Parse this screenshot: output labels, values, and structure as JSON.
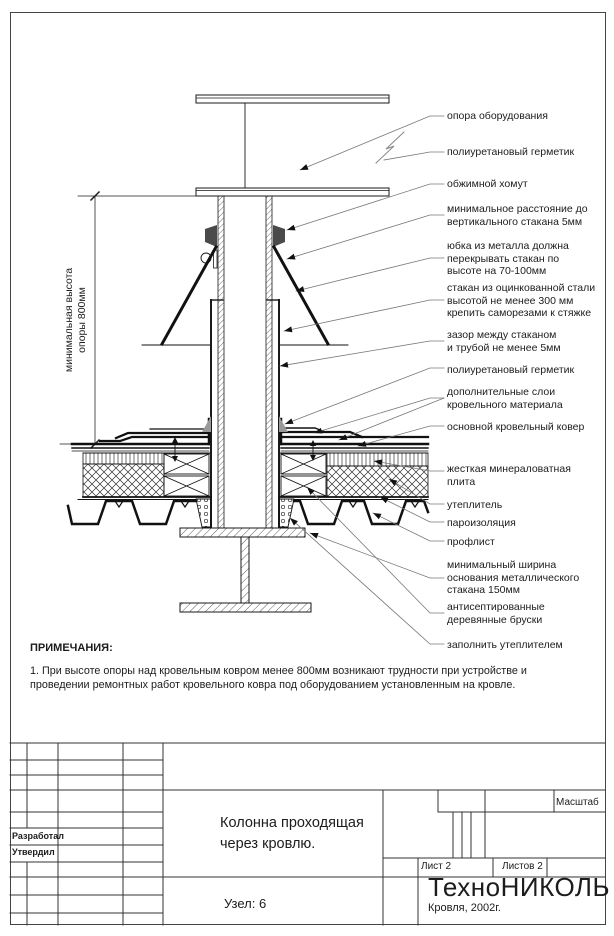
{
  "palette": {
    "line": "#1a1a1a",
    "leader": "#777777",
    "sealant_fill": "#999999",
    "clamp_fill": "#4a4a4a"
  },
  "drawing_labels": {
    "equipment_support": "опора оборудования",
    "sealant_top": "полиуретановый герметик",
    "clamp": "обжимной хомут",
    "min_distance": "минимальное расстояние до\nвертикального стакана 5мм",
    "skirt": "юбка из металла должна\nперекрывать стакан по\nвысоте на 70-100мм",
    "sleeve": "стакан из оцинкованной стали\nвысотой не менее 300 мм\nкрепить саморезами к стяжке",
    "gap": "зазор между стаканом\nи трубой не менее 5мм",
    "sealant_bottom": "полиуретановый герметик",
    "extra_layers": "дополнительные слои\nкровельного материала",
    "main_carpet": "основной кровельный ковер",
    "mineral_plate": "жесткая минераловатная\nплита",
    "insulation": "утеплитель",
    "vapor_barrier": "пароизоляция",
    "profiled_sheet": "профлист",
    "base_width": "минимальный ширина\nоснования металлического\nстакана 150мм",
    "wooden_blocks": "антисептированные\nдеревянные бруски",
    "fill_insulation": "заполнить утеплителем"
  },
  "dimension": {
    "height_note": "минимальная высота\nопоры 800мм"
  },
  "notes": {
    "title": "ПРИМЕЧАНИЯ:",
    "item1": "1. При высоте опоры над кровельным ковром менее 800мм возникают трудности при устройстве и\nпроведении ремонтных работ кровельного ковра под оборудованием установленным на кровле."
  },
  "title_block": {
    "developed_label": "Разработал",
    "approved_label": "Утвердил",
    "title": "Колонна проходящая\nчерез кровлю.",
    "node": "Узел: 6",
    "scale_label": "Масштаб",
    "sheet_label": "Лист 2",
    "sheets_label": "Листов 2",
    "company": "ТехноНИКОЛЬ",
    "series": "Кровля, 2002г."
  }
}
